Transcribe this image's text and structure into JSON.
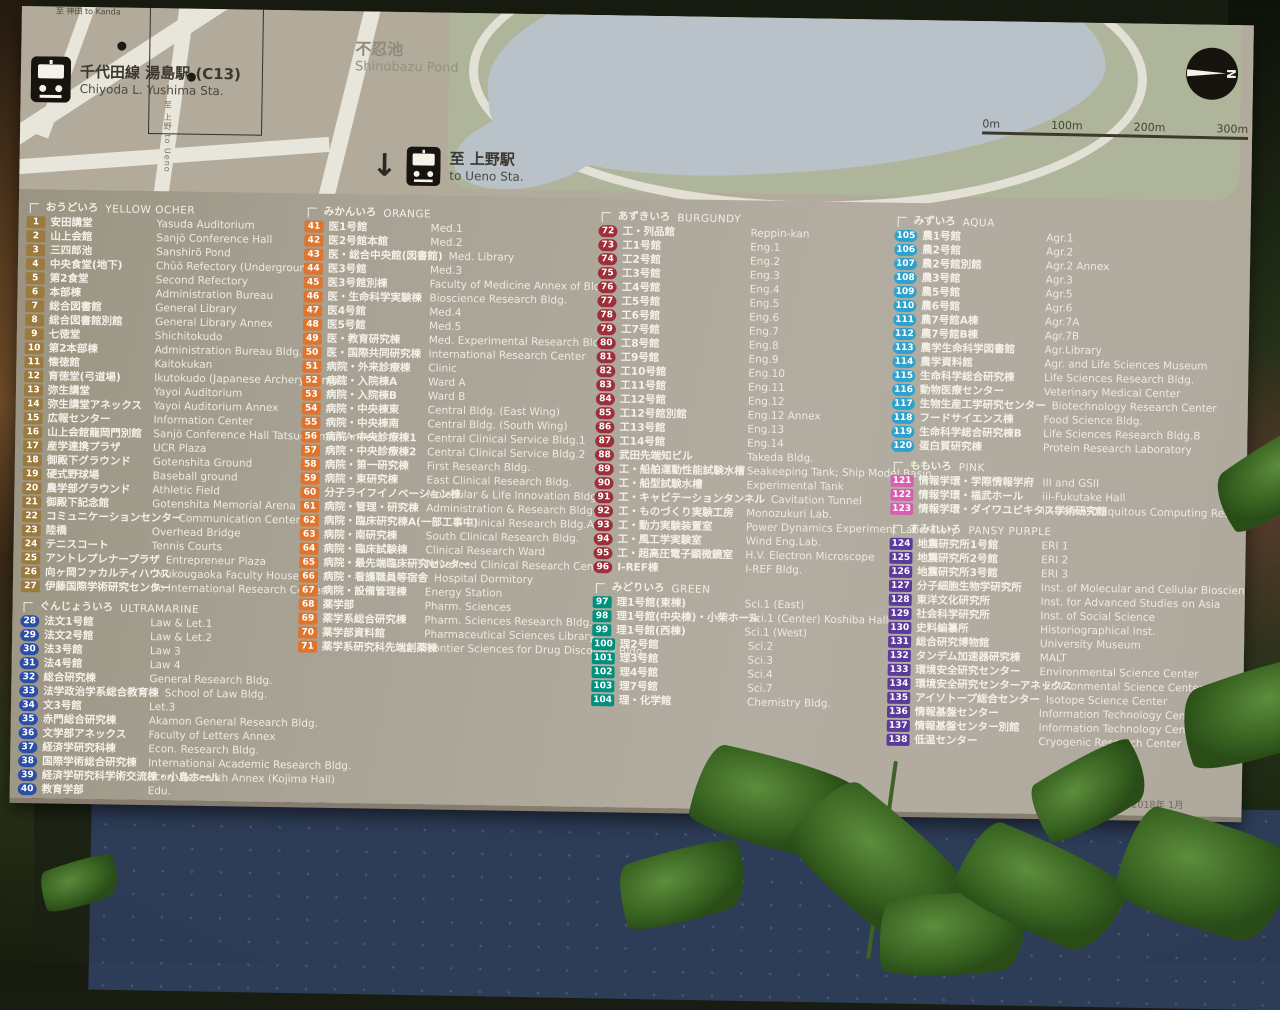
{
  "sign": {
    "date": "2018年 1月",
    "map": {
      "kanda_label": "至 神田 to Kanda",
      "station_name_jp": "千代田線 湯島駅 (C13)",
      "station_name_en": "Chiyoda L. Yushima Sta.",
      "pond_name_jp": "不忍池",
      "pond_name_en": "Shinobazu Pond",
      "ueno_arrow": "↓",
      "ueno_jp": "至 上野駅",
      "ueno_en": "to Ueno Sta.",
      "road_label_vertical": "至 上野 to Ueno",
      "scale_labels": [
        "0m",
        "100m",
        "200m",
        "300m"
      ],
      "compass_letter": "N"
    },
    "legend": {
      "columns": [
        [
          "yellow-ocher",
          "ultramarine"
        ],
        [
          "orange"
        ],
        [
          "burgundy",
          "green"
        ],
        [
          "aqua",
          "pink",
          "pansy-purple"
        ]
      ],
      "sections": [
        {
          "id": "yellow-ocher",
          "jp": "おうどいろ",
          "en": "YELLOW OCHER",
          "shape": "square",
          "color": "#9c7a3e",
          "items": [
            [
              1,
              "安田講堂",
              "Yasuda Auditorium"
            ],
            [
              2,
              "山上会館",
              "Sanjō Conference Hall"
            ],
            [
              3,
              "三四郎池",
              "Sanshirō Pond"
            ],
            [
              4,
              "中央食堂(地下)",
              "Chūō Refectory (Underground)"
            ],
            [
              5,
              "第2食堂",
              "Second Refectory"
            ],
            [
              6,
              "本部棟",
              "Administration Bureau"
            ],
            [
              7,
              "総合図書館",
              "General Library"
            ],
            [
              8,
              "総合図書館別館",
              "General Library Annex"
            ],
            [
              9,
              "七徳堂",
              "Shichitokudo"
            ],
            [
              10,
              "第2本部棟",
              "Administration Bureau Bldg.2"
            ],
            [
              11,
              "懐徳館",
              "Kaitokukan"
            ],
            [
              12,
              "育徳堂(弓道場)",
              "Ikutokudo (Japanese Archery Range)"
            ],
            [
              13,
              "弥生講堂",
              "Yayoi Auditorium"
            ],
            [
              14,
              "弥生講堂アネックス",
              "Yayoi Auditorium Annex"
            ],
            [
              15,
              "広報センター",
              "Information Center"
            ],
            [
              16,
              "山上会館龍岡門別館",
              "Sanjō Conference Hall Tatsuokamon Annex"
            ],
            [
              17,
              "産学連携プラザ",
              "UCR Plaza"
            ],
            [
              18,
              "御殿下グラウンド",
              "Gotenshita Ground"
            ],
            [
              19,
              "硬式野球場",
              "Baseball ground"
            ],
            [
              20,
              "農学部グラウンド",
              "Athletic Field"
            ],
            [
              21,
              "御殿下記念館",
              "Gotenshita Memorial Arena"
            ],
            [
              22,
              "コミュニケーションセンター",
              "Communication Center"
            ],
            [
              23,
              "陸橋",
              "Overhead Bridge"
            ],
            [
              24,
              "テニスコート",
              "Tennis Courts"
            ],
            [
              25,
              "アントレプレナープラザ",
              "Entrepreneur Plaza"
            ],
            [
              26,
              "向ヶ岡ファカルティハウス",
              "Mukougaoka Faculty House"
            ],
            [
              27,
              "伊藤国際学術研究センター",
              "Ito International Research Center"
            ]
          ]
        },
        {
          "id": "ultramarine",
          "jp": "ぐんじょういろ",
          "en": "ULTRAMARINE",
          "shape": "circle",
          "color": "#2b4fa8",
          "items": [
            [
              28,
              "法文1号館",
              "Law & Let.1"
            ],
            [
              29,
              "法文2号館",
              "Law & Let.2"
            ],
            [
              30,
              "法3号館",
              "Law 3"
            ],
            [
              31,
              "法4号館",
              "Law 4"
            ],
            [
              32,
              "総合研究棟",
              "General Research Bldg."
            ],
            [
              33,
              "法学政治学系総合教育棟",
              "School of Law Bldg."
            ],
            [
              34,
              "文3号館",
              "Let.3"
            ],
            [
              35,
              "赤門総合研究棟",
              "Akamon General Research Bldg."
            ],
            [
              36,
              "文学部アネックス",
              "Faculty of Letters Annex"
            ],
            [
              37,
              "経済学研究科棟",
              "Econ. Research Bldg."
            ],
            [
              38,
              "国際学術総合研究棟",
              "International Academic Research Bldg."
            ],
            [
              39,
              "経済学研究科学術交流棟・小島ホール",
              "Econ. Research Annex (Kojima Hall)"
            ],
            [
              40,
              "教育学部",
              "Edu."
            ]
          ]
        },
        {
          "id": "orange",
          "jp": "みかんいろ",
          "en": "ORANGE",
          "shape": "square",
          "color": "#e0742c",
          "items": [
            [
              41,
              "医1号館",
              "Med.1"
            ],
            [
              42,
              "医2号館本館",
              "Med.2"
            ],
            [
              43,
              "医・総合中央館(図書館)",
              "Med. Library"
            ],
            [
              44,
              "医3号館",
              "Med.3"
            ],
            [
              45,
              "医3号館別棟",
              "Faculty of Medicine Annex of Bldg.3"
            ],
            [
              46,
              "医・生命科学実験棟",
              "Bioscience Research Bldg."
            ],
            [
              47,
              "医4号館",
              "Med.4"
            ],
            [
              48,
              "医5号館",
              "Med.5"
            ],
            [
              49,
              "医・教育研究棟",
              "Med. Experimental Research Bldg."
            ],
            [
              50,
              "医・国際共同研究棟",
              "International Research Center"
            ],
            [
              51,
              "病院・外来診療棟",
              "Clinic"
            ],
            [
              52,
              "病院・入院棟A",
              "Ward A"
            ],
            [
              53,
              "病院・入院棟B",
              "Ward B"
            ],
            [
              54,
              "病院・中央棟東",
              "Central Bldg. (East Wing)"
            ],
            [
              55,
              "病院・中央棟南",
              "Central Bldg. (South Wing)"
            ],
            [
              56,
              "病院・中央診療棟1",
              "Central Clinical Service Bldg.1"
            ],
            [
              57,
              "病院・中央診療棟2",
              "Central Clinical Service Bldg.2"
            ],
            [
              58,
              "病院・第一研究棟",
              "First Research Bldg."
            ],
            [
              59,
              "病院・東研究棟",
              "East Clinical Research Bldg."
            ],
            [
              60,
              "分子ライフイノベーション棟",
              "Molecular & Life Innovation Bldg."
            ],
            [
              61,
              "病院・管理・研究棟",
              "Administration & Research Bldg."
            ],
            [
              62,
              "病院・臨床研究棟A(一部工事中)",
              "Clinical Research Bldg.A"
            ],
            [
              63,
              "病院・南研究棟",
              "South Clinical Research Bldg."
            ],
            [
              64,
              "病院・臨床試験棟",
              "Clinical Research Ward"
            ],
            [
              65,
              "病院・最先端臨床研究センター",
              "Advanced Clinical Research Center"
            ],
            [
              66,
              "病院・看護職員等宿舎",
              "Hospital Dormitory"
            ],
            [
              67,
              "病院・設備管理棟",
              "Energy Station"
            ],
            [
              68,
              "薬学部",
              "Pharm. Sciences"
            ],
            [
              69,
              "薬学系総合研究棟",
              "Pharm. Sciences Research Bldg."
            ],
            [
              70,
              "薬学部資料館",
              "Pharmaceutical Sciences Library"
            ],
            [
              71,
              "薬学系研究科先端創薬棟",
              "Frontier Sciences for Drug Discovery Bldg."
            ]
          ]
        },
        {
          "id": "burgundy",
          "jp": "あずきいろ",
          "en": "BURGUNDY",
          "shape": "circle",
          "color": "#9e2f3a",
          "items": [
            [
              72,
              "工・列品館",
              "Reppin-kan"
            ],
            [
              73,
              "工1号館",
              "Eng.1"
            ],
            [
              74,
              "工2号館",
              "Eng.2"
            ],
            [
              75,
              "工3号館",
              "Eng.3"
            ],
            [
              76,
              "工4号館",
              "Eng.4"
            ],
            [
              77,
              "工5号館",
              "Eng.5"
            ],
            [
              78,
              "工6号館",
              "Eng.6"
            ],
            [
              79,
              "工7号館",
              "Eng.7"
            ],
            [
              80,
              "工8号館",
              "Eng.8"
            ],
            [
              81,
              "工9号館",
              "Eng.9"
            ],
            [
              82,
              "工10号館",
              "Eng.10"
            ],
            [
              83,
              "工11号館",
              "Eng.11"
            ],
            [
              84,
              "工12号館",
              "Eng.12"
            ],
            [
              85,
              "工12号館別館",
              "Eng.12 Annex"
            ],
            [
              86,
              "工13号館",
              "Eng.13"
            ],
            [
              87,
              "工14号館",
              "Eng.14"
            ],
            [
              88,
              "武田先端知ビル",
              "Takeda Bldg."
            ],
            [
              89,
              "工・船舶運動性能試験水槽",
              "Seakeeping Tank; Ship Model Basin"
            ],
            [
              90,
              "工・船型試験水槽",
              "Experimental Tank"
            ],
            [
              91,
              "工・キャビテーションタンネル",
              "Cavitation Tunnel"
            ],
            [
              92,
              "工・ものづくり実験工房",
              "Monozukuri Lab."
            ],
            [
              93,
              "工・動力実験装置室",
              "Power Dynamics Experiment Laboratory"
            ],
            [
              94,
              "工・風工学実験室",
              "Wind Eng.Lab."
            ],
            [
              95,
              "工・超高圧電子顕微鏡室",
              "H.V. Electron Microscope"
            ],
            [
              96,
              "I-REF棟",
              "I-REF Bldg."
            ]
          ]
        },
        {
          "id": "green",
          "jp": "みどりいろ",
          "en": "GREEN",
          "shape": "square",
          "color": "#00917e",
          "items": [
            [
              97,
              "理1号館(東棟)",
              "Sci.1 (East)"
            ],
            [
              98,
              "理1号館(中央棟)・小柴ホール",
              "Sci.1 (Center) Koshiba Hall"
            ],
            [
              99,
              "理1号館(西棟)",
              "Sci.1 (West)"
            ],
            [
              100,
              "理2号館",
              "Sci.2"
            ],
            [
              101,
              "理3号館",
              "Sci.3"
            ],
            [
              102,
              "理4号館",
              "Sci.4"
            ],
            [
              103,
              "理7号館",
              "Sci.7"
            ],
            [
              104,
              "理・化学館",
              "Chemistry Bldg."
            ]
          ]
        },
        {
          "id": "aqua",
          "jp": "みずいろ",
          "en": "AQUA",
          "shape": "circle",
          "color": "#2ea2cc",
          "items": [
            [
              105,
              "農1号館",
              "Agr.1"
            ],
            [
              106,
              "農2号館",
              "Agr.2"
            ],
            [
              107,
              "農2号館別館",
              "Agr.2 Annex"
            ],
            [
              108,
              "農3号館",
              "Agr.3"
            ],
            [
              109,
              "農5号館",
              "Agr.5"
            ],
            [
              110,
              "農6号館",
              "Agr.6"
            ],
            [
              111,
              "農7号館A棟",
              "Agr.7A"
            ],
            [
              112,
              "農7号館B棟",
              "Agr.7B"
            ],
            [
              113,
              "農学生命科学図書館",
              "Agr.Library"
            ],
            [
              114,
              "農学資料館",
              "Agr. and Life Sciences Museum"
            ],
            [
              115,
              "生命科学総合研究棟",
              "Life Sciences Research Bldg."
            ],
            [
              116,
              "動物医療センター",
              "Veterinary Medical Center"
            ],
            [
              117,
              "生物生産工学研究センター",
              "Biotechnology Research Center"
            ],
            [
              118,
              "フードサイエンス棟",
              "Food Science Bldg."
            ],
            [
              119,
              "生命科学総合研究棟B",
              "Life Sciences Research Bldg.B"
            ],
            [
              120,
              "蛋白質研究棟",
              "Protein Research Laboratory"
            ]
          ]
        },
        {
          "id": "pink",
          "jp": "ももいろ",
          "en": "PINK",
          "shape": "square",
          "color": "#d85fb0",
          "items": [
            [
              121,
              "情報学環・学際情報学府",
              "III and GSII"
            ],
            [
              122,
              "情報学環・福武ホール",
              "iii-Fukutake Hall"
            ],
            [
              123,
              "情報学環・ダイワユビキタス学術研究館",
              "iii-Daiwa Ubiquitous Computing Research Bldg.",
              null,
              true
            ]
          ]
        },
        {
          "id": "pansy-purple",
          "jp": "すみれいろ",
          "en": "PANSY PURPLE",
          "shape": "square",
          "color": "#5b3a9b",
          "items": [
            [
              124,
              "地震研究所1号館",
              "ERI 1"
            ],
            [
              125,
              "地震研究所2号館",
              "ERI 2"
            ],
            [
              126,
              "地震研究所3号館",
              "ERI 3"
            ],
            [
              127,
              "分子細胞生物学研究所",
              "Inst. of Molecular and Cellular Biosciences"
            ],
            [
              128,
              "東洋文化研究所",
              "Inst. for Advanced Studies on Asia"
            ],
            [
              129,
              "社会科学研究所",
              "Inst. of Social Science"
            ],
            [
              130,
              "史料編纂所",
              "Historiographical Inst."
            ],
            [
              131,
              "総合研究博物館",
              "University Museum"
            ],
            [
              132,
              "タンデム加速器研究棟",
              "MALT"
            ],
            [
              133,
              "環境安全研究センター",
              "Environmental Science Center"
            ],
            [
              134,
              "環境安全研究センターアネックス",
              "Environmental Science Center Annex"
            ],
            [
              135,
              "アイソトープ総合センター",
              "Isotope Science Center"
            ],
            [
              136,
              "情報基盤センター",
              "Information Technology Center"
            ],
            [
              137,
              "情報基盤センター別館",
              "Information Technology Center Annex"
            ],
            [
              138,
              "低温センター",
              "Cryogenic Research Center"
            ]
          ]
        }
      ]
    },
    "colors": {
      "board": "#aca69b",
      "base_panel": "#2d3c57",
      "pond": "#b9c2c8",
      "park": "#afb59a",
      "road": "#e8e5db"
    }
  }
}
